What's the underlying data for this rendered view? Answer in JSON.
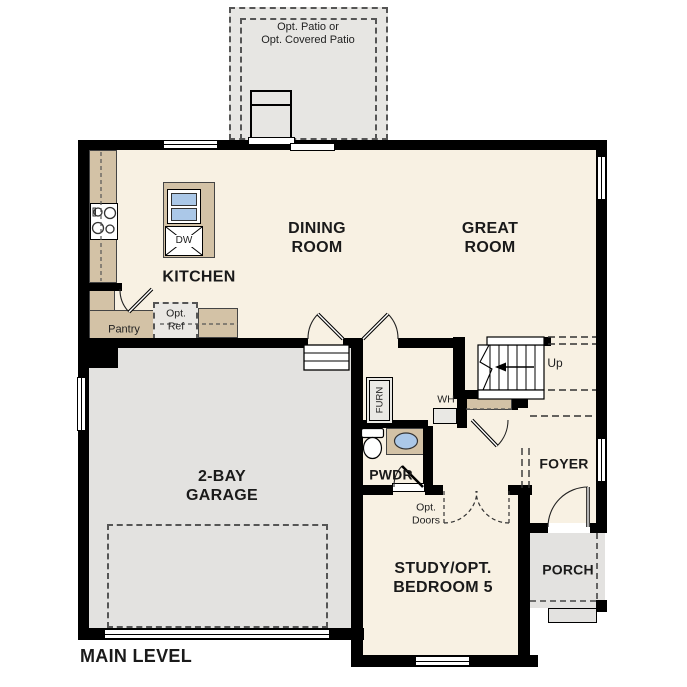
{
  "plan_title": "MAIN LEVEL",
  "rooms": {
    "patio": "Opt. Patio or\nOpt. Covered Patio",
    "dining_room": "DINING\nROOM",
    "great_room": "GREAT\nROOM",
    "kitchen": "KITCHEN",
    "pantry": "Pantry",
    "garage": "2-BAY\nGARAGE",
    "powder_room": "PWDR",
    "study": "STUDY/OPT.\nBEDROOM 5",
    "foyer": "FOYER",
    "porch": "PORCH"
  },
  "fixtures": {
    "dishwasher": "DW",
    "furnace": "FURN",
    "water_heater": "WH",
    "opt_refrigerator": "Opt.\nRef",
    "opt_doors": "Opt.\nDoors",
    "stairs_direction": "Up"
  },
  "colors": {
    "floor": "#f8f1e3",
    "cabinetry": "#d3c2a6",
    "garage_floor": "#e3e2e0",
    "patio_floor": "#e7e6e3",
    "sink": "#abc8e8",
    "wall": "#000000"
  }
}
